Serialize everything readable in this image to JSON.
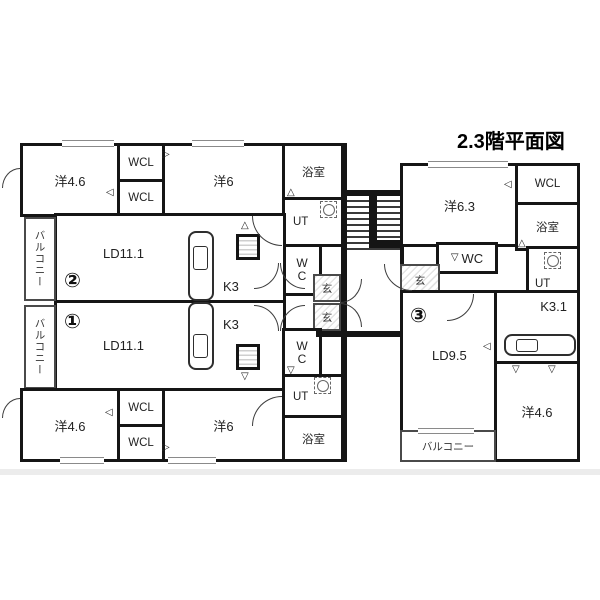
{
  "title": "2.3階平面図",
  "icons": {
    "tri_up": "△",
    "tri_down": "▽",
    "tri_left": "◁",
    "tri_right": "▷"
  },
  "units": {
    "u1": "①",
    "u2": "②",
    "u3": "③"
  },
  "lb": {
    "yo46_top": "洋4.6",
    "wcl_a": "WCL",
    "wcl_b": "WCL",
    "yo6_top": "洋6",
    "bath_top": "浴室",
    "ut_top": "UT",
    "wc_top": "WC",
    "balcony2": "バルコニー",
    "ld2": "LD11.1",
    "k2": "K3",
    "genkan2": "玄",
    "balcony1": "バルコニー",
    "ld1": "LD11.1",
    "k1": "K3",
    "genkan1": "玄",
    "wc_bot": "WC",
    "ut_bot": "UT",
    "bath_bot": "浴室",
    "yo46_bot": "洋4.6",
    "wcl_c": "WCL",
    "wcl_d": "WCL",
    "yo6_bot": "洋6"
  },
  "rb": {
    "yo63": "洋6.3",
    "wcl": "WCL",
    "bath": "浴室",
    "wc": "WC",
    "genkan": "玄",
    "ut": "UT",
    "ld": "LD9.5",
    "k": "K3.1",
    "yo46": "洋4.6",
    "balcony": "バルコニー"
  },
  "colors": {
    "wall": "#151515",
    "bg": "#ffffff",
    "band": "#ececec"
  }
}
